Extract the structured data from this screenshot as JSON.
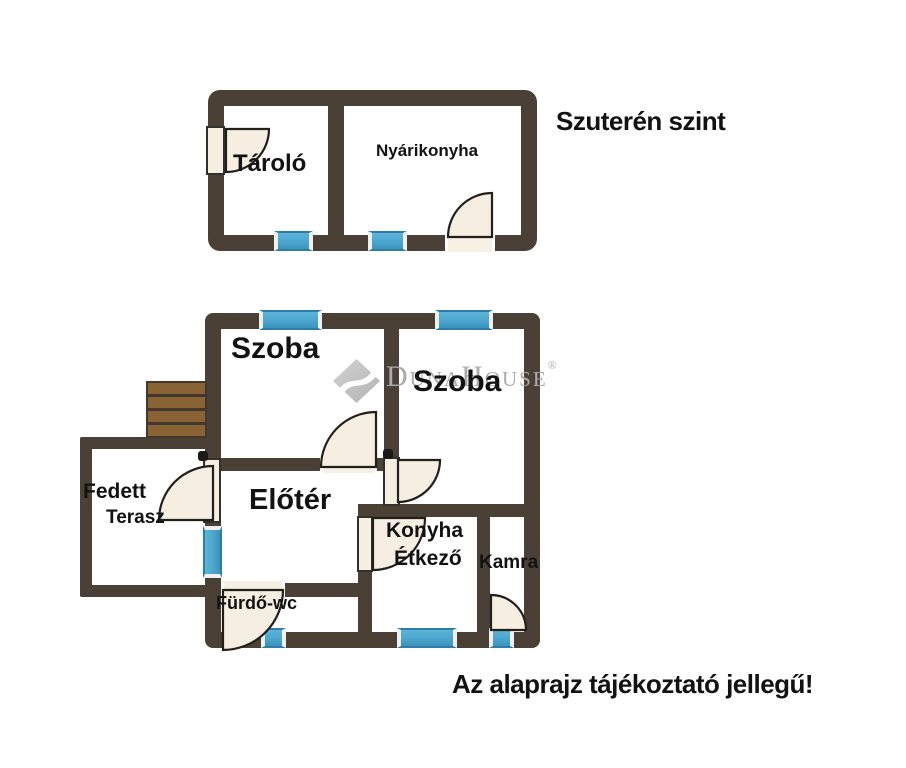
{
  "upper_plan": {
    "title": "Szuterén szint",
    "rooms": {
      "tarolo": "Tároló",
      "nyarikonyha": "Nyárikonyha"
    }
  },
  "main_plan": {
    "rooms": {
      "szoba_left": "Szoba",
      "szoba_right": "Szoba",
      "eloter": "Előtér",
      "fedett": "Fedett",
      "terasz": "Terasz",
      "konyha": "Konyha",
      "etkezo": "Étkező",
      "kamra": "Kamra",
      "furdo_wc": "Fürdő-wc"
    }
  },
  "watermark": {
    "text": "DunaHouse",
    "registered": "®"
  },
  "footer_note": "Az alaprajz tájékoztató jellegű!",
  "colors": {
    "wall": "#4b4036",
    "window": "#4aa6cf",
    "window_border": "#2d7ea6",
    "door_fill": "#f6eee1",
    "stairs": "#8a6334",
    "stairs_line": "#42382e",
    "watermark": "#ababab",
    "text": "#121212"
  }
}
